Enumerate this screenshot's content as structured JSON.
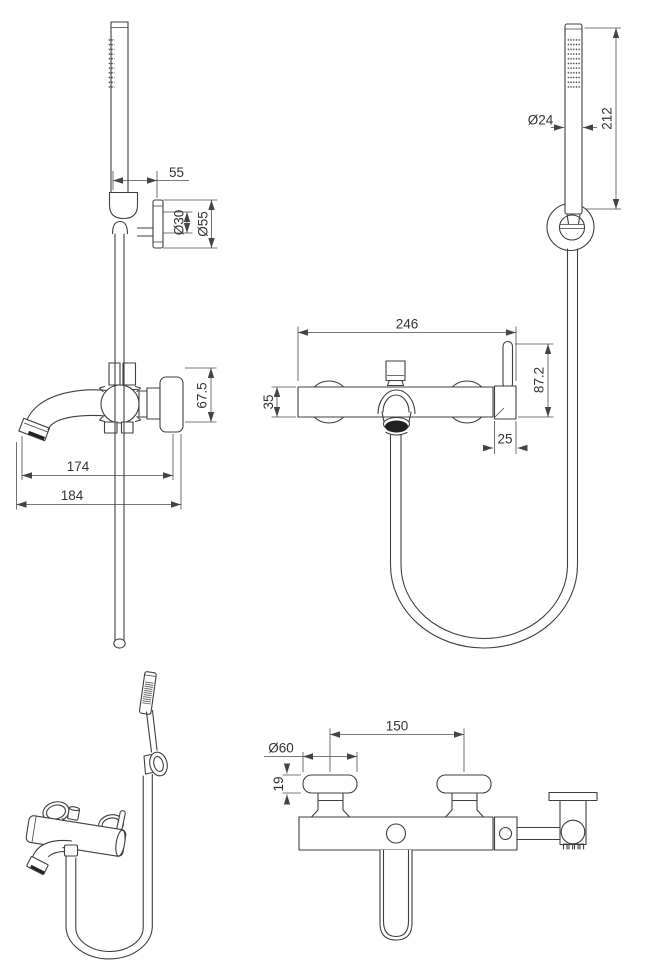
{
  "drawing": {
    "colors": {
      "background": "#ffffff",
      "object_line": "#3f3f3f",
      "dimension_line": "#4d4d4d",
      "text": "#333333",
      "dark_fill": "#222222"
    },
    "views": {
      "hand_shower_side": {
        "dims": {
          "bracket_offset": "55",
          "escutcheon_inner": "Ø30",
          "escutcheon_outer": "Ø55"
        }
      },
      "hand_shower_front": {
        "dims": {
          "head_diameter": "Ø24",
          "wand_length": "212"
        }
      },
      "mixer_front": {
        "dims": {
          "overall_width": "246",
          "lever_height": "87.2",
          "body_diameter": "35",
          "lever_base_width": "25"
        }
      },
      "mixer_side": {
        "dims": {
          "assembly_height": "67.5",
          "spout_reach": "174",
          "overall_depth": "184"
        }
      },
      "mixer_top": {
        "dims": {
          "inlet_centres": "150",
          "flange_diameter": "Ø60",
          "flange_depth": "19"
        }
      }
    }
  }
}
